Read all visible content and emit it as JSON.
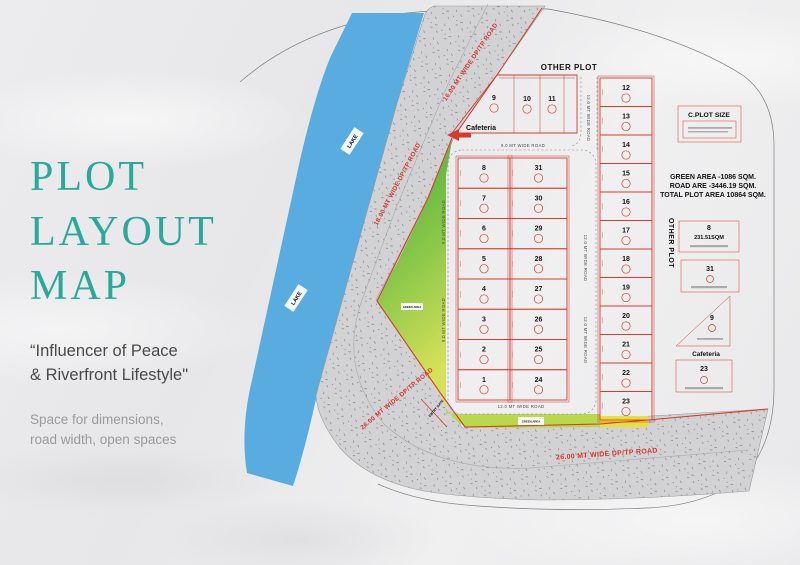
{
  "panel": {
    "title_lines": [
      "PLOT",
      "LAYOUT",
      "MAP"
    ],
    "tagline_lines": [
      "“Influencer of Peace",
      "& Riverfront Lifestyle\""
    ],
    "subtext_lines": [
      "Space for dimensions,",
      "road width, open spaces"
    ]
  },
  "map": {
    "labels": {
      "other_plot_top": "OTHER PLOT",
      "other_plot_side": "OTHER PLOT",
      "lake": "LAKE",
      "cafeteria": "Cafeteria",
      "green_area": "GREEN AREA",
      "c_plot_size": "C.PLOT SIZE",
      "gate": "ENTRY GATE"
    },
    "stats": [
      "GREEN AREA -1086 SQM.",
      "ROAD ARE -3446.19 SQM.",
      "TOTAL PLOT AREA 10864 SQM."
    ],
    "road_labels": [
      "16.00 MT WIDE DP/TP ROAD",
      "18.00 MT WIDE DP/TP ROAD",
      "26.00 MT WIDE DP/TP ROAD",
      "26.00 MT WIDE DP/TP ROAD",
      "9.0 MT WIDE ROAD",
      "12.0 MT WIDE ROAD",
      "9.0 MT WIDE ROAD",
      "9.0 MT WIDE ROAD",
      "12.0 MT WIDE ROAD",
      "12.0 MT WIDE ROAD",
      "12.0 MT WIDE ROAD"
    ],
    "plots": {
      "north": [
        "9",
        "10",
        "11"
      ],
      "central_left": [
        "8",
        "7",
        "6",
        "5",
        "4",
        "3",
        "2",
        "1"
      ],
      "central_right": [
        "31",
        "30",
        "29",
        "28",
        "27",
        "26",
        "25",
        "24"
      ],
      "east": [
        "12",
        "13",
        "14",
        "15",
        "16",
        "17",
        "18",
        "19",
        "20",
        "21",
        "22",
        "23"
      ]
    },
    "details": [
      {
        "num": "8",
        "area": "231.51SQM"
      },
      {
        "num": "31"
      },
      {
        "num": "9",
        "caption": "Cafeteria"
      },
      {
        "num": "23"
      }
    ],
    "colors": {
      "teal": "#2BA89A",
      "red": "#D63B2C",
      "lake": "#58ACE0",
      "road": "#D2D2D4",
      "green_top": "#3FA93A",
      "green_bottom": "#D6E059",
      "yellow": "#E6E03C"
    }
  }
}
